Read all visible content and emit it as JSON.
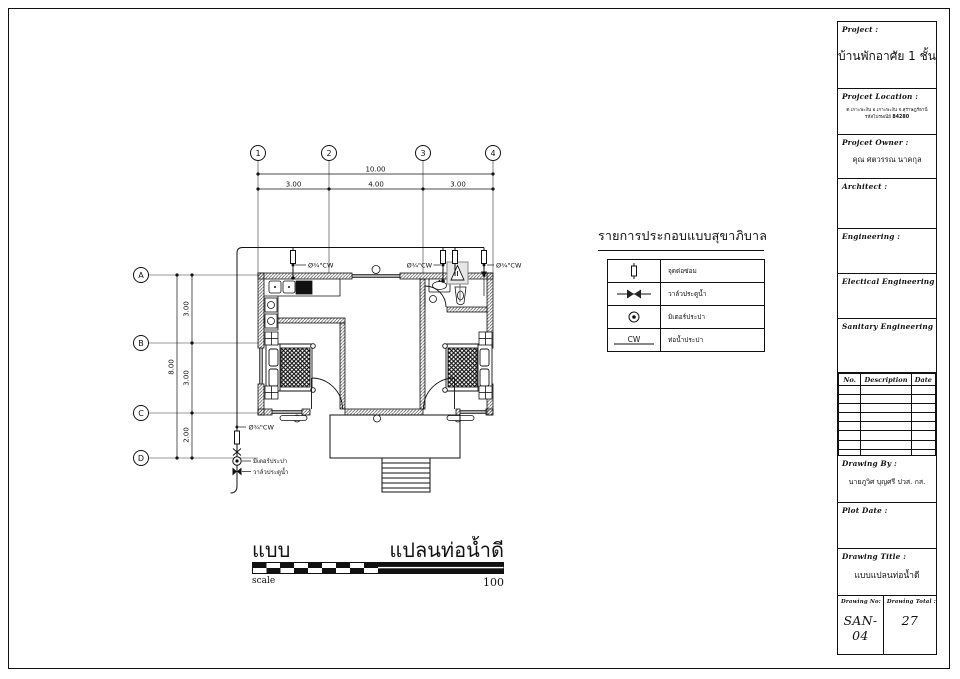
{
  "sheet": {
    "bg": "#ffffff",
    "line_color": "#111111"
  },
  "title_block": {
    "project_label": "Project :",
    "project_value": "บ้านพักอาศัย 1 ชั้น",
    "location_label": "Projcet Location :",
    "location_line1": "ต.เกาะพะงัน อ.เกาะพะงัน จ.สุราษฎร์ธานี",
    "location_line2_prefix": "รหัสไปรษณีย์",
    "location_postcode": "84280",
    "owner_label": "Projcet Owner :",
    "owner_value": "คุณ ศตวรรณ นาคกุล",
    "architect_label": "Architect :",
    "engineering_label": "Engineering :",
    "electrical_label": "Electical Engineering :",
    "sanitary_label": "Sanitary Engineering :",
    "rev_headers": [
      "No.",
      "Description",
      "Date"
    ],
    "drawing_by_label": "Drawing By :",
    "drawing_by_value": "นายภูวิศ บุญศรี ปวส. กส.",
    "plot_date_label": "Plot Date :",
    "drawing_title_label": "Drawing Title :",
    "drawing_title_value": "แบบแปลนท่อน้ำดี",
    "drawing_no_label": "Drawing No:",
    "drawing_no_value": "SAN-04",
    "drawing_total_label": "Drawing Total :",
    "drawing_total_value": "27"
  },
  "legend": {
    "title": "รายการประกอบแบบสุขาภิบาล",
    "rows": [
      {
        "symbol": "pipe-riser",
        "label": "จุดต่อซ่อม"
      },
      {
        "symbol": "gate-valve",
        "label": "วาล์วประตูน้ำ"
      },
      {
        "symbol": "water-meter",
        "label": "มิเตอร์ประปา"
      },
      {
        "symbol": "cold-water-pipe",
        "symbol_text": "CW",
        "label": "ท่อน้ำประปา"
      }
    ]
  },
  "plan": {
    "grid_cols": [
      "1",
      "2",
      "3",
      "4"
    ],
    "grid_rows": [
      "A",
      "B",
      "C",
      "D"
    ],
    "dim_width_total": "10.00",
    "dim_widths": [
      "3.00",
      "4.00",
      "3.00"
    ],
    "dim_height_total": "8.00",
    "dim_heights": [
      "3.00",
      "3.00",
      "2.00"
    ],
    "pipe_size_label": "Ø¾\"CW",
    "meter_label": "มิเตอร์ประปา",
    "valve_label": "วาล์วประตูน้ำ"
  },
  "footer": {
    "sheet_name_left": "แบบ",
    "sheet_name_right": "แปลนท่อน้ำดี",
    "scale_label": "scale",
    "scale_value": "100"
  }
}
